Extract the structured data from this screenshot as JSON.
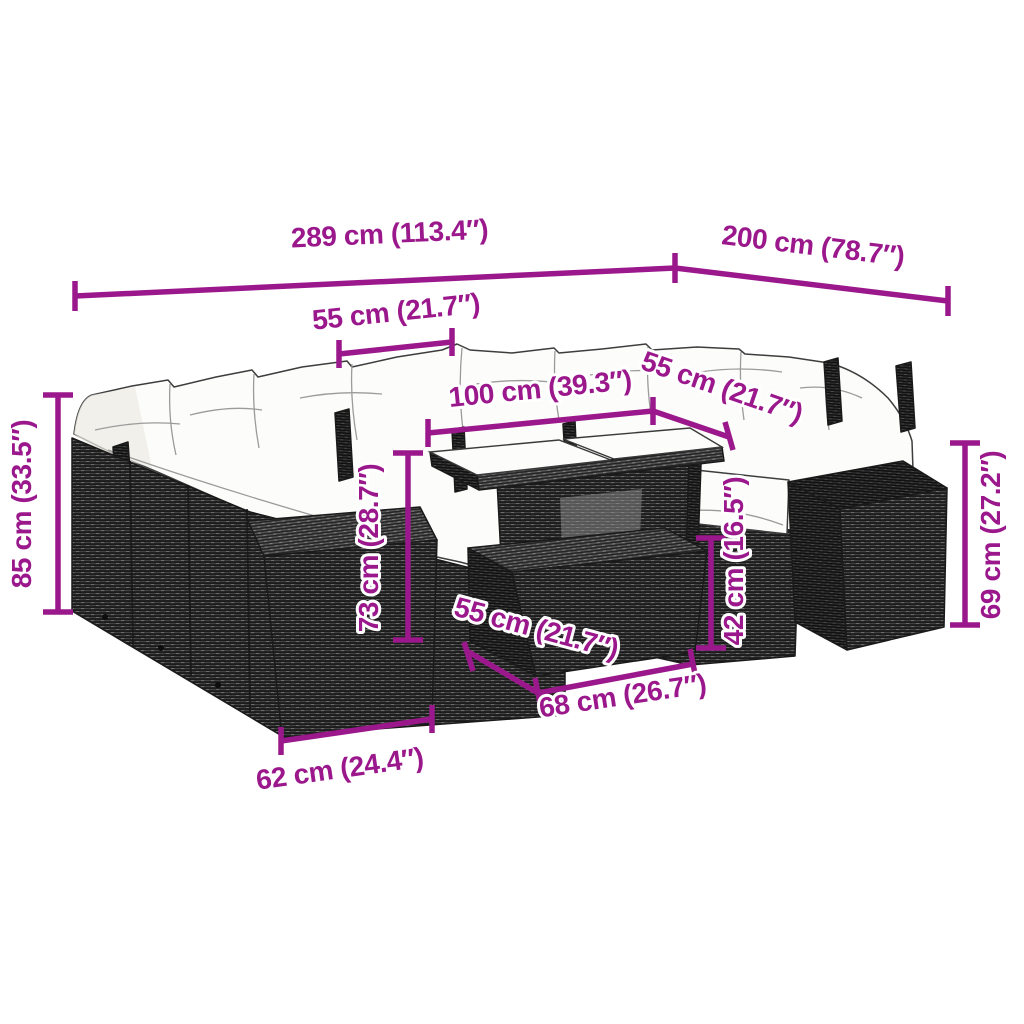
{
  "diagram": {
    "type": "product-dimension-diagram",
    "subject": "rattan-garden-lounge-set-with-table-and-stools",
    "colors": {
      "dimension": "#9B188C",
      "background": "#FFFFFF",
      "wicker": "#414141",
      "cushion": "#FCFCFA"
    },
    "dimensions": {
      "total_width": {
        "label": "289 cm (113.4″)"
      },
      "total_depth": {
        "label": "200 cm (78.7″)"
      },
      "seat_width": {
        "label": "55 cm (21.7″)"
      },
      "table_length": {
        "label": "100 cm (39.3″)"
      },
      "table_depth": {
        "label": "55 cm (21.7″)"
      },
      "total_height": {
        "label": "85 cm (33.5″)"
      },
      "table_height": {
        "label": "73 cm (28.7″)"
      },
      "stool_height": {
        "label": "42 cm (16.5″)"
      },
      "armrest_height": {
        "label": "69 cm (27.2″)"
      },
      "stool_depth": {
        "label": "55 cm (21.7″)"
      },
      "stool_width": {
        "label": "68 cm (26.7″)"
      },
      "ottoman_width": {
        "label": "62 cm (24.4″)"
      }
    }
  }
}
